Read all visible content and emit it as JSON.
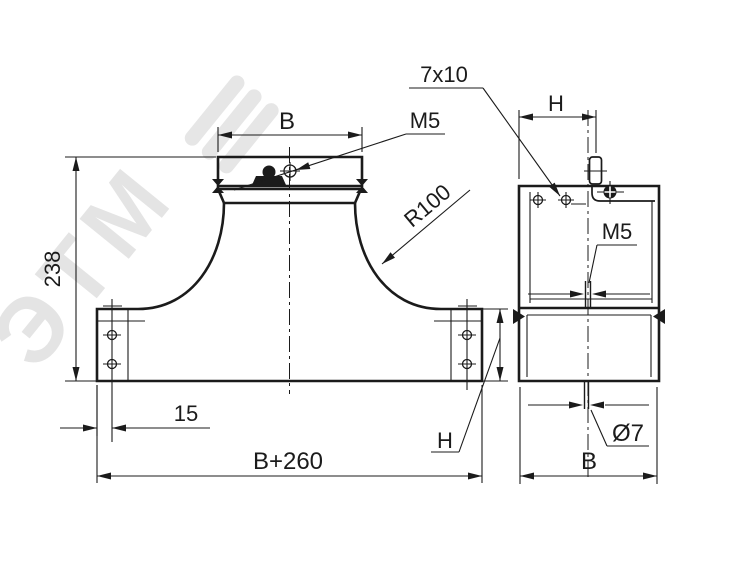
{
  "drawing": {
    "labels": {
      "b_top": "B",
      "m5_front": "M5",
      "slot": "7x10",
      "h_side": "H",
      "radius": "R100",
      "height": "238",
      "offset": "15",
      "total_width": "B+260",
      "h_front": "H",
      "m5_side": "M5",
      "hole_dia": "Ø7",
      "b_side": "B"
    },
    "watermark": {
      "text": "ЭТМ"
    },
    "colors": {
      "ink": "#1b1b1b",
      "watermark": "#d6d6d6",
      "background": "#ffffff"
    }
  }
}
